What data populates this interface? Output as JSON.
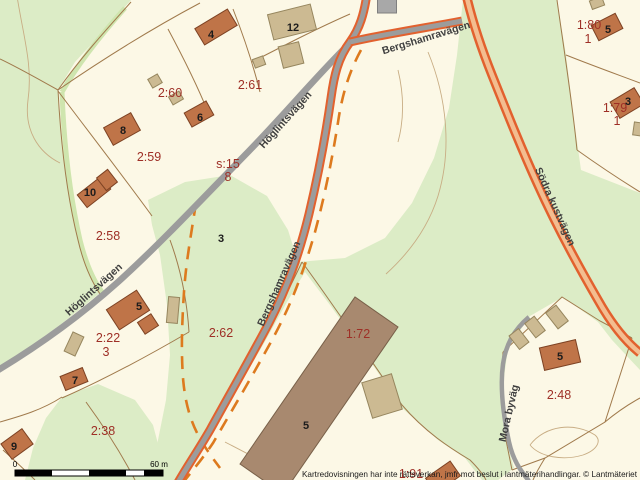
{
  "map": {
    "colors": {
      "background": "#fcf8e6",
      "forest_green": "#dcecc6",
      "forest_band": "#cfe5ae",
      "parcel_line": "#a07a4c",
      "contour_line": "#c8ad84",
      "dashed_line": "#dd7a1e",
      "road_gray": "#9c9c9c",
      "road_casing_orange": "#e2612e",
      "road_core_peach": "#f3bd90",
      "building_brown": "#bf7448",
      "building_brown_stroke": "#7d4223",
      "building_tan": "#ccba92",
      "building_tan_stroke": "#96865e",
      "building_large": "#a8896f",
      "building_large_stroke": "#786049",
      "building_gray": "#a8a8a8",
      "building_gray_stroke": "#7f7f7f",
      "label_red": "#9e2f26",
      "label_black": "#1c1c1c",
      "label_road": "#3f3f3f"
    },
    "greens": [
      "M0,0 L131,0 L100,35 L75,62 L58,90 L62,140 L68,185 L76,232 L86,265 L100,293 L60,325 L25,350 L0,368 Z",
      "M148,200 L185,182 L230,175 L267,196 L288,230 L298,262 L345,258 L385,238 L412,203 L434,158 L449,108 L457,55 L463,0 L557,0 L566,55 L574,120 L581,170 L640,193 L640,370 L612,340 L598,322 L563,297 L530,316 L508,348 L502,392 L506,440 L514,468 L498,480 L482,480 L465,458 L438,440 L402,408 L368,358 L330,305 L305,272 L287,302 L263,345 L238,388 L213,430 L194,462 L184,480 L152,480 L158,440 L166,400 L170,355 L167,305 L160,255 L152,225 Z",
      "M62,397 L98,384 L135,400 L153,425 L161,455 L163,480 L25,480 L33,448 L46,418 Z"
    ],
    "green_bands": [
      "M125,8 C100,36 78,64 62,92",
      "M62,92 C64,146 70,196 80,240 C86,264 93,280 102,292"
    ],
    "contour_lines": [
      "M17,-4 C23,35 33,65 28,100 C24,130 38,152 60,163",
      "M428,52 C447,98 452,150 438,196 C428,228 408,254 386,274",
      "M398,70 C404,95 404,120 398,142",
      "M530,445 C545,425 575,422 595,435 C602,441 597,450 583,455 C563,461 540,457 530,445",
      "M225,442 C250,455 272,466 292,480"
    ],
    "parcel_lines": [
      "M131,2 C104,32 79,60 58,90",
      "M58,90 C61,148 68,200 78,240 C84,266 92,282 100,294",
      "M58,90 C38,79 19,68 0,59",
      "M58,90 C106,57 153,28 200,3",
      "M168,29 C183,57 197,85 208,112",
      "M233,9 C244,37 253,64 260,92",
      "M58,91 C88,131 120,172 152,216",
      "M252,62 C285,45 318,28 350,14",
      "M170,240 C181,270 187,300 189,332",
      "M189,332 C148,356 103,380 62,398",
      "M62,397 C42,410 21,416 0,422",
      "M3,450 C14,460 25,470 35,480",
      "M86,402 C105,428 122,455 135,480",
      "M302,262 C285,298 262,342 238,386 C214,428 196,455 180,478",
      "M302,262 C330,300 365,352 402,405 C425,432 450,448 470,460 C478,468 483,474 486,480",
      "M503,352 L562,297 L600,321 L632,338",
      "M632,338 L605,422 L545,458 L512,470",
      "M503,352 L501,390 L506,440 L512,470",
      "M566,55 C591,65 616,74 640,83",
      "M577,150 C598,165 619,179 640,192",
      "M557,0 C564,50 572,100 577,150",
      "M605,422 C617,412 629,404 640,398",
      "M545,458 C540,466 536,473 533,480"
    ],
    "dashed_lines": [
      "M361,50 C350,70 343,92 339,116 C333,155 325,195 315,232 C303,274 290,307 272,340 C254,373 234,407 213,443 C201,461 191,472 182,484",
      "M196,203 C191,235 186,262 184,292 C182,322 181,350 183,378 C185,402 190,422 202,442 C208,452 214,460 220,468"
    ],
    "roads": [
      {
        "name": "hoglintsvagen",
        "style": "gray",
        "width": 6.5,
        "path": "M-5,372 C40,345 80,316 118,282 C160,244 205,196 248,152 C285,114 320,72 352,41"
      },
      {
        "name": "mora-byvag",
        "style": "gray",
        "width": 4.5,
        "path": "M529,317 C514,330 506,344 503,364 C500,386 503,414 509,442 C513,460 520,470 529,481"
      },
      {
        "name": "bergshamravagen",
        "style": "cased-gray",
        "casing_width": 9,
        "width": 5,
        "path": "M367,-6 C364,14 360,28 350,42 C338,58 334,76 331,98 C325,140 318,176 309,214 C299,255 287,288 269,323 C251,357 231,392 210,430 C196,454 186,468 176,486"
      },
      {
        "name": "bergshamravagen-link",
        "style": "cased-gray",
        "casing_width": 9,
        "width": 5,
        "path": "M350,42 C385,34 425,28 462,21"
      },
      {
        "name": "sodra-kustvagen",
        "style": "cased-peach",
        "casing_width": 9.5,
        "width": 4.5,
        "path": "M466,-6 C472,20 480,45 492,75 C508,115 522,150 538,185 C556,225 576,262 598,300 C612,325 625,341 640,353"
      }
    ],
    "buildings": [
      {
        "cx": 216,
        "cy": 27,
        "w": 38,
        "h": 19,
        "rot": -31,
        "type": "brown"
      },
      {
        "cx": 292,
        "cy": 22,
        "w": 44,
        "h": 26,
        "rot": -14,
        "type": "tan"
      },
      {
        "cx": 291,
        "cy": 55,
        "w": 21,
        "h": 22,
        "rot": -14,
        "type": "tan"
      },
      {
        "cx": 259,
        "cy": 62,
        "w": 11,
        "h": 9,
        "rot": -20,
        "type": "tan"
      },
      {
        "cx": 155,
        "cy": 81,
        "w": 11,
        "h": 10,
        "rot": -30,
        "type": "tan"
      },
      {
        "cx": 176,
        "cy": 98,
        "w": 12,
        "h": 9,
        "rot": -30,
        "type": "tan"
      },
      {
        "cx": 199,
        "cy": 114,
        "w": 25,
        "h": 16,
        "rot": -29,
        "type": "brown"
      },
      {
        "cx": 122,
        "cy": 129,
        "w": 31,
        "h": 20,
        "rot": -29,
        "type": "brown"
      },
      {
        "cx": 94,
        "cy": 192,
        "w": 30,
        "h": 16,
        "rot": -38,
        "type": "brown"
      },
      {
        "cx": 107,
        "cy": 180,
        "w": 14,
        "h": 16,
        "rot": -38,
        "type": "brown"
      },
      {
        "cx": 387,
        "cy": 6,
        "w": 19,
        "h": 14,
        "rot": 0,
        "type": "gray"
      },
      {
        "cx": 597,
        "cy": 3,
        "w": 13,
        "h": 9,
        "rot": -20,
        "type": "tan"
      },
      {
        "cx": 607,
        "cy": 27,
        "w": 27,
        "h": 17,
        "rot": -27,
        "type": "brown"
      },
      {
        "cx": 627,
        "cy": 103,
        "w": 28,
        "h": 19,
        "rot": -31,
        "type": "brown"
      },
      {
        "cx": 638,
        "cy": 129,
        "w": 9,
        "h": 13,
        "rot": 8,
        "type": "tan"
      },
      {
        "cx": 128,
        "cy": 310,
        "w": 36,
        "h": 24,
        "rot": -33,
        "type": "brown"
      },
      {
        "cx": 148,
        "cy": 324,
        "w": 16,
        "h": 14,
        "rot": -33,
        "type": "brown"
      },
      {
        "cx": 74,
        "cy": 344,
        "w": 21,
        "h": 12,
        "rot": -65,
        "type": "tan"
      },
      {
        "cx": 173,
        "cy": 310,
        "w": 11,
        "h": 26,
        "rot": 5,
        "type": "tan"
      },
      {
        "cx": 74,
        "cy": 379,
        "w": 24,
        "h": 15,
        "rot": -22,
        "type": "brown"
      },
      {
        "cx": 17,
        "cy": 444,
        "w": 26,
        "h": 19,
        "rot": -36,
        "type": "brown"
      },
      {
        "poly": "240,464 355,297 398,327 283,494",
        "type": "large"
      },
      {
        "cx": 382,
        "cy": 396,
        "w": 31,
        "h": 37,
        "rot": -17,
        "type": "tan"
      },
      {
        "cx": 519,
        "cy": 339,
        "w": 12,
        "h": 17,
        "rot": -38,
        "type": "tan"
      },
      {
        "cx": 535,
        "cy": 327,
        "w": 12,
        "h": 18,
        "rot": -38,
        "type": "tan"
      },
      {
        "cx": 557,
        "cy": 317,
        "w": 13,
        "h": 20,
        "rot": -38,
        "type": "tan"
      },
      {
        "cx": 560,
        "cy": 355,
        "w": 37,
        "h": 23,
        "rot": -13,
        "type": "brown"
      },
      {
        "cx": 443,
        "cy": 477,
        "w": 30,
        "h": 18,
        "rot": -35,
        "type": "brown"
      }
    ],
    "parcel_labels": [
      {
        "text": "2:60",
        "x": 170,
        "y": 97
      },
      {
        "text": "2:61",
        "x": 250,
        "y": 89
      },
      {
        "text": "2:59",
        "x": 149,
        "y": 161
      },
      {
        "text": "2:58",
        "x": 108,
        "y": 240
      },
      {
        "text": "s:15",
        "x": 228,
        "y": 168
      },
      {
        "text": "8",
        "x": 228,
        "y": 181
      },
      {
        "text": "2:22",
        "x": 108,
        "y": 342
      },
      {
        "text": "3",
        "x": 106,
        "y": 356
      },
      {
        "text": "2:62",
        "x": 221,
        "y": 337
      },
      {
        "text": "2:38",
        "x": 103,
        "y": 435
      },
      {
        "text": "1:72",
        "x": 358,
        "y": 338
      },
      {
        "text": "1:91",
        "x": 411,
        "y": 478
      },
      {
        "text": "2:48",
        "x": 559,
        "y": 399
      },
      {
        "text": "1:80",
        "x": 589,
        "y": 29
      },
      {
        "text": "1",
        "x": 588,
        "y": 43
      },
      {
        "text": "1:79",
        "x": 615,
        "y": 112
      },
      {
        "text": "1",
        "x": 617,
        "y": 125
      }
    ],
    "building_labels": [
      {
        "text": "4",
        "x": 211,
        "y": 38
      },
      {
        "text": "12",
        "x": 293,
        "y": 31
      },
      {
        "text": "6",
        "x": 200,
        "y": 121
      },
      {
        "text": "8",
        "x": 123,
        "y": 134
      },
      {
        "text": "10",
        "x": 90,
        "y": 196
      },
      {
        "text": "5",
        "x": 139,
        "y": 310
      },
      {
        "text": "7",
        "x": 75,
        "y": 384
      },
      {
        "text": "9",
        "x": 14,
        "y": 450
      },
      {
        "text": "3",
        "x": 221,
        "y": 242
      },
      {
        "text": "5",
        "x": 306,
        "y": 429
      },
      {
        "text": "5",
        "x": 560,
        "y": 360
      },
      {
        "text": "5",
        "x": 608,
        "y": 33
      },
      {
        "text": "3",
        "x": 628,
        "y": 105
      }
    ],
    "road_labels": [
      {
        "text": "Höglintsvägen",
        "x": 288,
        "y": 122,
        "rot": -48
      },
      {
        "text": "Höglintsvägen",
        "x": 96,
        "y": 292,
        "rot": -42
      },
      {
        "text": "Bergshamravägen",
        "x": 427,
        "y": 41,
        "rot": -17
      },
      {
        "text": "Bergshamravägen",
        "x": 282,
        "y": 285,
        "rot": -66
      },
      {
        "text": "Södra kustvägen",
        "x": 552,
        "y": 208,
        "rot": 66
      },
      {
        "text": "Mora byväg",
        "x": 512,
        "y": 414,
        "rot": -77
      }
    ],
    "scalebar": {
      "x": 15,
      "y": 470,
      "width": 148,
      "height": 6,
      "black_segments": [
        [
          15,
          37
        ],
        [
          89,
          37
        ],
        [
          144,
          19
        ]
      ],
      "start_label": "0",
      "end_label": "60 m"
    },
    "copyright": "Kartredovisningen har inte rättsverkan, jmfr mot beslut i lantmäterihandlingar. © Lantmäteriet"
  }
}
